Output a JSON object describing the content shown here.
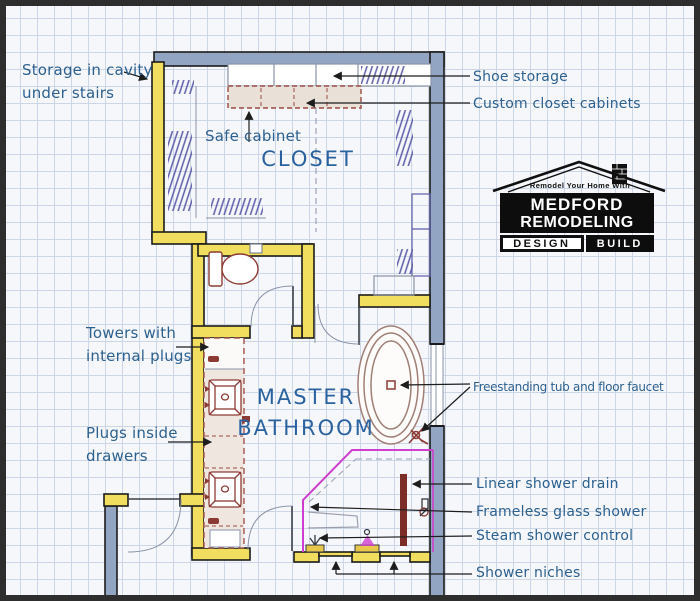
{
  "plan": {
    "rooms": {
      "closet": "CLOSET",
      "master_bathroom": "MASTER\nBATHROOM"
    },
    "annotations": {
      "storage_cavity": "Storage in cavity\nunder stairs",
      "safe_cabinet": "Safe cabinet",
      "shoe_storage": "Shoe storage",
      "custom_closet_cabinets": "Custom closet cabinets",
      "towers_with_plugs": "Towers with\ninternal plugs",
      "plugs_inside_drawers": "Plugs inside\ndrawers",
      "freestanding_tub": "Freestanding tub and floor faucet",
      "linear_shower_drain": "Linear shower drain",
      "frameless_glass_shower": "Frameless glass shower",
      "steam_shower_control": "Steam shower control",
      "shower_niches": "Shower niches"
    },
    "colors": {
      "new_wall_yellow": "#f1dd5e",
      "exterior_wall_blue_gray": "#92a5c2",
      "cabinet_tan": "#e9e1d8",
      "fixture_dark_red": "#8c3b34",
      "tub_outline": "#a07f76",
      "shower_glass_magenta": "#cf3fcf",
      "closet_hatch_blue": "#5d5daa",
      "label_text_blue": "#2d6190",
      "grid_line": "#ccd6e7",
      "leader_line": "#1d1d1d"
    }
  },
  "logo": {
    "tagline": "Remodel Your Home With",
    "name_line1": "MEDFORD",
    "name_line2": "REMODELING",
    "design_label": "DESIGN",
    "build_label": "BUILD"
  }
}
